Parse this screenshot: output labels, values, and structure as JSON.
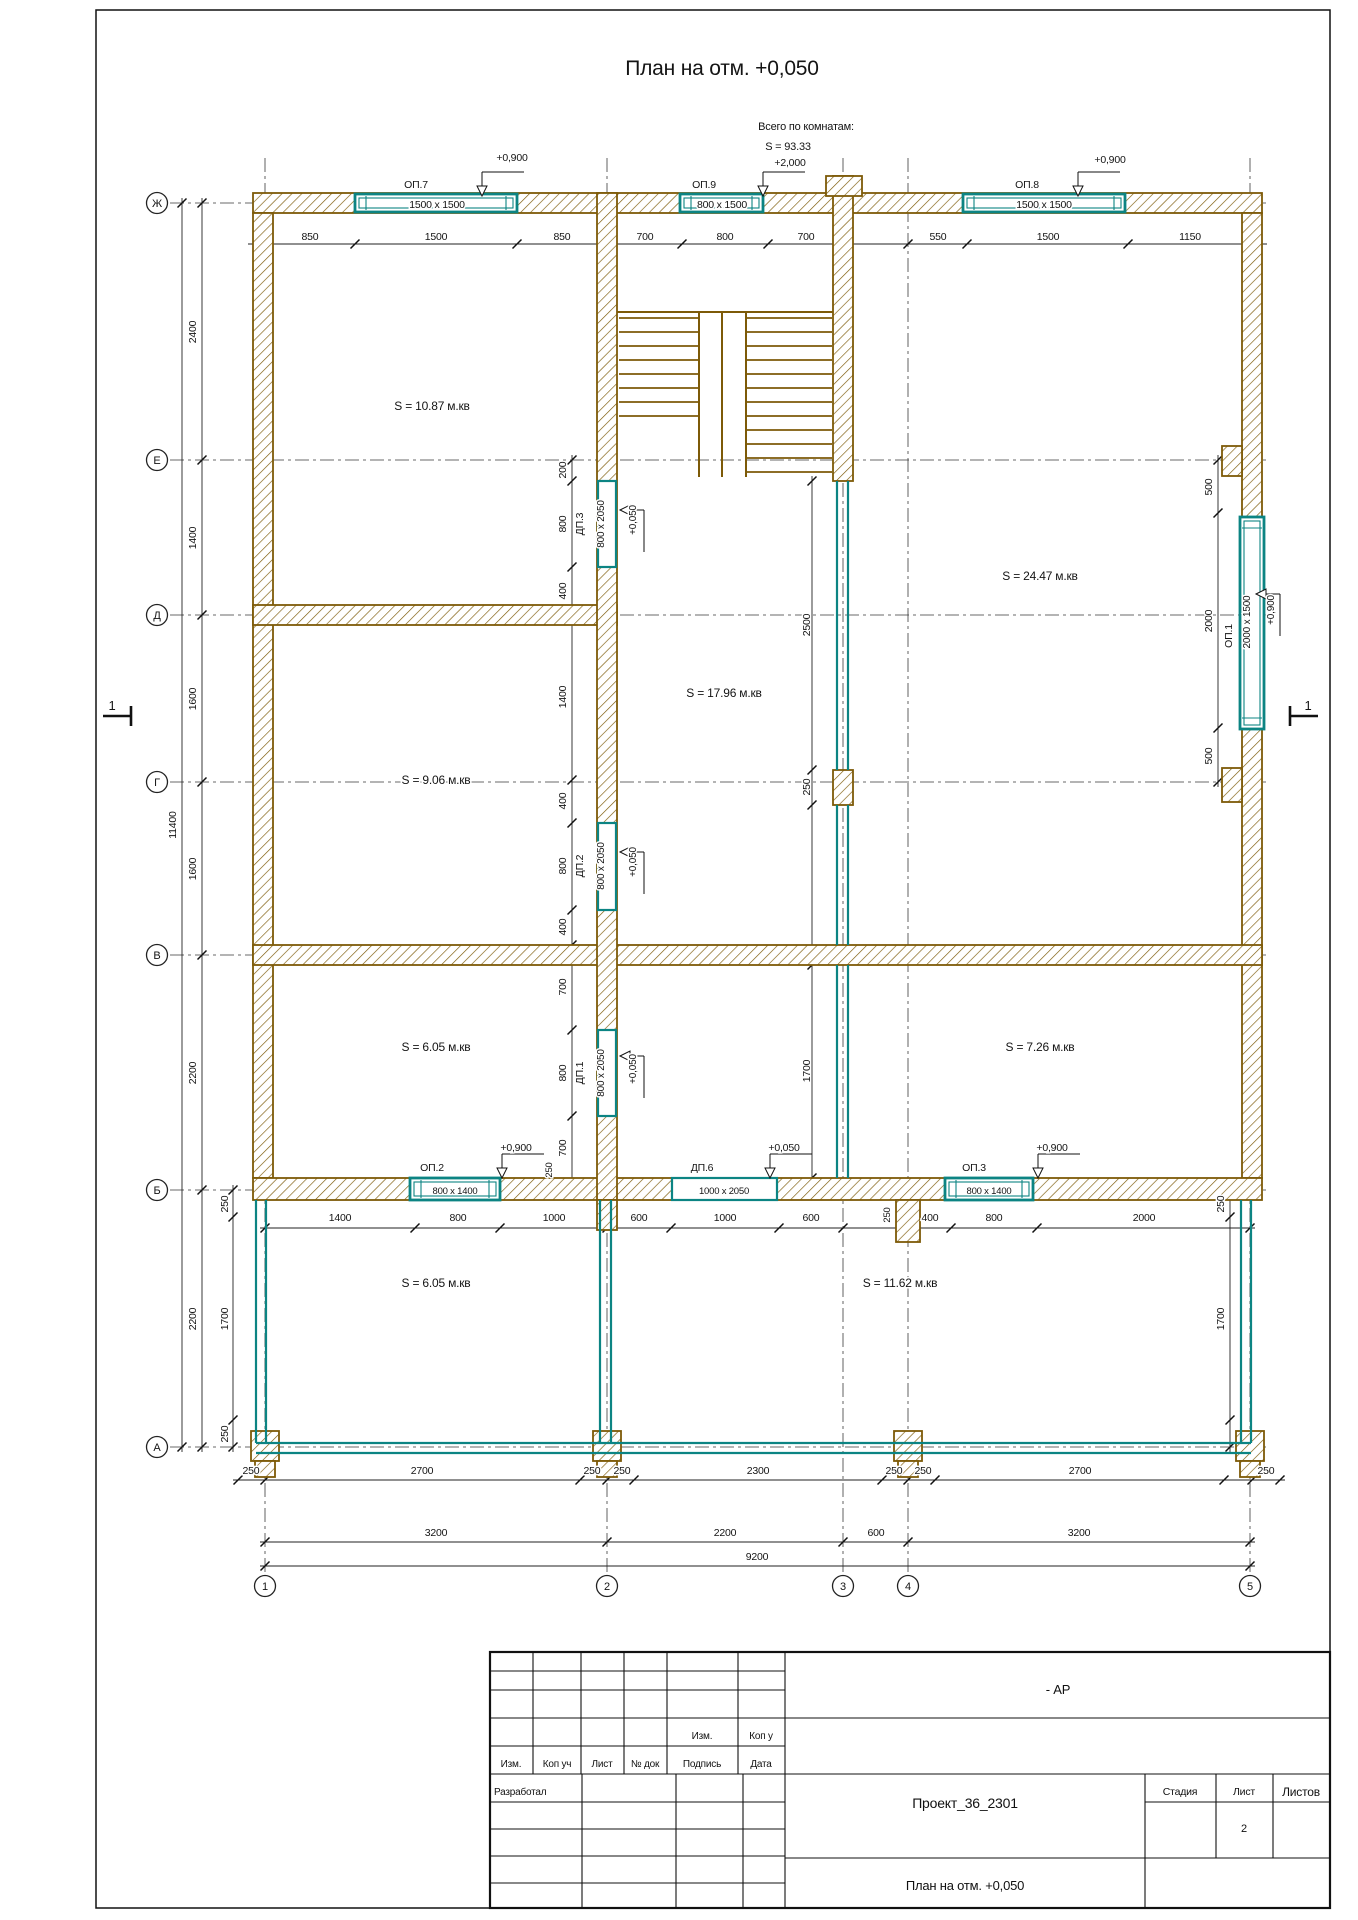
{
  "title": "План на отм. +0,050",
  "colors": {
    "wall": "#7d5a08",
    "window": "#0c8483",
    "line": "#1c1c1c",
    "axis": "#3a3a3a"
  },
  "axes": {
    "rows": [
      {
        "label": "Ж",
        "y": 203
      },
      {
        "label": "Е",
        "y": 460
      },
      {
        "label": "Д",
        "y": 615
      },
      {
        "label": "Г",
        "y": 782
      },
      {
        "label": "В",
        "y": 955
      },
      {
        "label": "Б",
        "y": 1190
      },
      {
        "label": "А",
        "y": 1447
      }
    ],
    "cols": [
      {
        "label": "1",
        "x": 265
      },
      {
        "label": "2",
        "x": 607
      },
      {
        "label": "3",
        "x": 843
      },
      {
        "label": "4",
        "x": 908
      },
      {
        "label": "5",
        "x": 1250
      }
    ]
  },
  "title_block": {
    "code_suffix": "- АР",
    "upper_izm": "Изм.",
    "upper_kop": "Коп у",
    "col_izm": "Изм.",
    "col_kop": "Коп уч",
    "col_list": "Лист",
    "col_ndok": "№ док",
    "col_podpis": "Подпись",
    "col_data": "Дата",
    "developed_by": "Разработал",
    "project_name": "Проект_36_2301",
    "stage_label": "Стадия",
    "sheet_label": "Лист",
    "sheets_label": "Листов",
    "sheet_number": "2",
    "drawing_name": "План на отм. +0,050"
  },
  "annotations": [
    {
      "n": "drawing-title",
      "t": "План на отм. +0,050",
      "x": 722,
      "y": 75,
      "s": 21
    },
    {
      "n": "note-rooms-total-1",
      "t": "Всего по комнатам:",
      "x": 806,
      "y": 130,
      "s": 11
    },
    {
      "n": "note-rooms-total-2",
      "t": "S  =  93.33",
      "x": 788,
      "y": 150,
      "s": 11
    },
    {
      "n": "level-top-middle",
      "t": "+2,000",
      "x": 790,
      "y": 166
    },
    {
      "n": "level-op7",
      "t": "+0,900",
      "x": 512,
      "y": 161
    },
    {
      "n": "level-op8",
      "t": "+0,900",
      "x": 1110,
      "y": 163
    },
    {
      "n": "op7-label",
      "t": "ОП.7",
      "x": 416,
      "y": 188
    },
    {
      "n": "op7-size",
      "t": "1500 х 1500",
      "x": 437,
      "y": 208
    },
    {
      "n": "op9-label",
      "t": "ОП.9",
      "x": 704,
      "y": 188
    },
    {
      "n": "op9-size",
      "t": "800 х 1500",
      "x": 722,
      "y": 208
    },
    {
      "n": "op8-label",
      "t": "ОП.8",
      "x": 1027,
      "y": 188
    },
    {
      "n": "op8-size",
      "t": "1500 х 1500",
      "x": 1044,
      "y": 208
    },
    {
      "n": "dim-top-1",
      "t": "850",
      "x": 310,
      "y": 240
    },
    {
      "n": "dim-top-2",
      "t": "1500",
      "x": 436,
      "y": 240
    },
    {
      "n": "dim-top-3",
      "t": "850",
      "x": 562,
      "y": 240
    },
    {
      "n": "dim-top-4",
      "t": "700",
      "x": 645,
      "y": 240
    },
    {
      "n": "dim-top-5",
      "t": "800",
      "x": 725,
      "y": 240
    },
    {
      "n": "dim-top-6",
      "t": "700",
      "x": 806,
      "y": 240
    },
    {
      "n": "dim-top-7",
      "t": "550",
      "x": 938,
      "y": 240
    },
    {
      "n": "dim-top-8",
      "t": "1500",
      "x": 1048,
      "y": 240
    },
    {
      "n": "dim-top-9",
      "t": "1150",
      "x": 1190,
      "y": 240
    },
    {
      "n": "dim-left-1",
      "t": "2400",
      "x": 196,
      "y": 332,
      "r": -90
    },
    {
      "n": "dim-left-2",
      "t": "1400",
      "x": 196,
      "y": 538,
      "r": -90
    },
    {
      "n": "dim-left-3",
      "t": "1600",
      "x": 196,
      "y": 699,
      "r": -90
    },
    {
      "n": "dim-left-4",
      "t": "1600",
      "x": 196,
      "y": 869,
      "r": -90
    },
    {
      "n": "dim-left-5",
      "t": "2200",
      "x": 196,
      "y": 1073,
      "r": -90
    },
    {
      "n": "dim-left-6",
      "t": "2200",
      "x": 196,
      "y": 1319,
      "r": -90
    },
    {
      "n": "dim-left-total",
      "t": "11400",
      "x": 176,
      "y": 825,
      "r": -90
    },
    {
      "n": "dim-left-sub-1",
      "t": "250",
      "x": 228,
      "y": 1204,
      "r": -90
    },
    {
      "n": "dim-left-sub-2",
      "t": "1700",
      "x": 228,
      "y": 1319,
      "r": -90
    },
    {
      "n": "dim-left-sub-3",
      "t": "250",
      "x": 228,
      "y": 1434,
      "r": -90
    },
    {
      "n": "dim-right-1",
      "t": "500",
      "x": 1212,
      "y": 487,
      "r": -90
    },
    {
      "n": "dim-right-2",
      "t": "2000",
      "x": 1212,
      "y": 621,
      "r": -90
    },
    {
      "n": "dim-right-3",
      "t": "500",
      "x": 1212,
      "y": 756,
      "r": -90
    },
    {
      "n": "dim-right-sub-1",
      "t": "250",
      "x": 1224,
      "y": 1204,
      "r": -90
    },
    {
      "n": "dim-right-sub-2",
      "t": "1700",
      "x": 1224,
      "y": 1319,
      "r": -90
    },
    {
      "n": "dim-ax2-1",
      "t": "200",
      "x": 566,
      "y": 470,
      "r": -90
    },
    {
      "n": "dim-ax2-2",
      "t": "800",
      "x": 566,
      "y": 524,
      "r": -90
    },
    {
      "n": "dim-ax2-3",
      "t": "400",
      "x": 566,
      "y": 591,
      "r": -90
    },
    {
      "n": "dim-ax2-4",
      "t": "1400",
      "x": 566,
      "y": 697,
      "r": -90
    },
    {
      "n": "dim-ax2-5",
      "t": "400",
      "x": 566,
      "y": 801,
      "r": -90
    },
    {
      "n": "dim-ax2-6",
      "t": "800",
      "x": 566,
      "y": 866,
      "r": -90
    },
    {
      "n": "dim-ax2-7",
      "t": "400",
      "x": 566,
      "y": 927,
      "r": -90
    },
    {
      "n": "dim-ax2-8",
      "t": "700",
      "x": 566,
      "y": 987,
      "r": -90
    },
    {
      "n": "dim-ax2-9",
      "t": "800",
      "x": 566,
      "y": 1073,
      "r": -90
    },
    {
      "n": "dim-ax2-10",
      "t": "700",
      "x": 566,
      "y": 1148,
      "r": -90
    },
    {
      "n": "dim-ax2-11",
      "t": "250",
      "x": 552,
      "y": 1170,
      "r": -90,
      "s": 9.5
    },
    {
      "n": "dim-ax3-1",
      "t": "2500",
      "x": 810,
      "y": 625,
      "r": -90
    },
    {
      "n": "dim-ax3-2",
      "t": "250",
      "x": 810,
      "y": 787,
      "r": -90
    },
    {
      "n": "dim-ax3-3",
      "t": "1700",
      "x": 810,
      "y": 1071,
      "r": -90
    },
    {
      "n": "dim-ax4-pier",
      "t": "250",
      "x": 890,
      "y": 1215,
      "r": -90,
      "s": 9.5
    },
    {
      "n": "dp3-label",
      "t": "ДП.3",
      "x": 583,
      "y": 524,
      "r": -90
    },
    {
      "n": "dp3-size",
      "t": "800 х 2050",
      "x": 604,
      "y": 524,
      "r": -90,
      "s": 10
    },
    {
      "n": "dp3-level",
      "t": "+0,050",
      "x": 636,
      "y": 520,
      "r": -90,
      "s": 10
    },
    {
      "n": "dp2-label",
      "t": "ДП.2",
      "x": 583,
      "y": 866,
      "r": -90
    },
    {
      "n": "dp2-size",
      "t": "800 х 2050",
      "x": 604,
      "y": 866,
      "r": -90,
      "s": 10
    },
    {
      "n": "dp2-level",
      "t": "+0,050",
      "x": 636,
      "y": 862,
      "r": -90,
      "s": 10
    },
    {
      "n": "dp1-label",
      "t": "ДП.1",
      "x": 583,
      "y": 1073,
      "r": -90
    },
    {
      "n": "dp1-size",
      "t": "800 х 2050",
      "x": 604,
      "y": 1073,
      "r": -90,
      "s": 10
    },
    {
      "n": "dp1-level",
      "t": "+0,050",
      "x": 636,
      "y": 1069,
      "r": -90,
      "s": 10
    },
    {
      "n": "op1-label",
      "t": "ОП.1",
      "x": 1232,
      "y": 636,
      "r": -90
    },
    {
      "n": "op1-size",
      "t": "2000 х 1500",
      "x": 1250,
      "y": 622,
      "r": -90,
      "s": 10
    },
    {
      "n": "op1-level",
      "t": "+0,900",
      "x": 1274,
      "y": 610,
      "r": -90,
      "s": 10
    },
    {
      "n": "op2-label",
      "t": "ОП.2",
      "x": 432,
      "y": 1171
    },
    {
      "n": "op2-size",
      "t": "800 х 1400",
      "x": 455,
      "y": 1194,
      "s": 9.5
    },
    {
      "n": "op2-level",
      "t": "+0,900",
      "x": 516,
      "y": 1151
    },
    {
      "n": "dp6-label",
      "t": "ДП.6",
      "x": 702,
      "y": 1171
    },
    {
      "n": "dp6-size",
      "t": "1000 х 2050",
      "x": 724,
      "y": 1194,
      "s": 9.5
    },
    {
      "n": "dp6-level",
      "t": "+0,050",
      "x": 784,
      "y": 1151
    },
    {
      "n": "op3-label",
      "t": "ОП.3",
      "x": 974,
      "y": 1171
    },
    {
      "n": "op3-size",
      "t": "800 х 1400",
      "x": 989,
      "y": 1194,
      "s": 9.5
    },
    {
      "n": "op3-level",
      "t": "+0,900",
      "x": 1052,
      "y": 1151
    },
    {
      "n": "room-area-1",
      "t": "S  =  10.87 м.кв",
      "x": 432,
      "y": 410,
      "s": 12
    },
    {
      "n": "room-area-2",
      "t": "S  =  24.47 м.кв",
      "x": 1040,
      "y": 580,
      "s": 12
    },
    {
      "n": "room-area-3",
      "t": "S  =  17.96 м.кв",
      "x": 724,
      "y": 697,
      "s": 12
    },
    {
      "n": "room-area-4",
      "t": "S  =  9.06 м.кв",
      "x": 436,
      "y": 784,
      "s": 12
    },
    {
      "n": "room-area-5",
      "t": "S  =  6.05 м.кв",
      "x": 436,
      "y": 1051,
      "s": 12
    },
    {
      "n": "room-area-6",
      "t": "S  =  7.26 м.кв",
      "x": 1040,
      "y": 1051,
      "s": 12
    },
    {
      "n": "room-area-7",
      "t": "S  =  6.05 м.кв",
      "x": 436,
      "y": 1287,
      "s": 12
    },
    {
      "n": "room-area-8",
      "t": "S  =  11.62 м.кв",
      "x": 900,
      "y": 1287,
      "s": 12
    },
    {
      "n": "dim-belowB-1",
      "t": "1400",
      "x": 340,
      "y": 1221
    },
    {
      "n": "dim-belowB-2",
      "t": "800",
      "x": 458,
      "y": 1221
    },
    {
      "n": "dim-belowB-3",
      "t": "1000",
      "x": 554,
      "y": 1221
    },
    {
      "n": "dim-belowB-4",
      "t": "600",
      "x": 639,
      "y": 1221
    },
    {
      "n": "dim-belowB-5",
      "t": "1000",
      "x": 725,
      "y": 1221
    },
    {
      "n": "dim-belowB-6",
      "t": "600",
      "x": 811,
      "y": 1221
    },
    {
      "n": "dim-belowB-7",
      "t": "400",
      "x": 930,
      "y": 1221
    },
    {
      "n": "dim-belowB-8",
      "t": "800",
      "x": 994,
      "y": 1221
    },
    {
      "n": "dim-belowB-9",
      "t": "2000",
      "x": 1144,
      "y": 1221
    },
    {
      "n": "dim-botA-1",
      "t": "250",
      "x": 251,
      "y": 1474
    },
    {
      "n": "dim-botA-2",
      "t": "2700",
      "x": 422,
      "y": 1474
    },
    {
      "n": "dim-botA-3",
      "t": "250",
      "x": 592,
      "y": 1474
    },
    {
      "n": "dim-botA-4",
      "t": "250",
      "x": 622,
      "y": 1474
    },
    {
      "n": "dim-botA-5",
      "t": "2300",
      "x": 758,
      "y": 1474
    },
    {
      "n": "dim-botA-6",
      "t": "250",
      "x": 894,
      "y": 1474
    },
    {
      "n": "dim-botA-7",
      "t": "250",
      "x": 923,
      "y": 1474
    },
    {
      "n": "dim-botA-8",
      "t": "2700",
      "x": 1080,
      "y": 1474
    },
    {
      "n": "dim-botA-9",
      "t": "250",
      "x": 1266,
      "y": 1474
    },
    {
      "n": "dim-botB-1",
      "t": "3200",
      "x": 436,
      "y": 1536
    },
    {
      "n": "dim-botB-2",
      "t": "2200",
      "x": 725,
      "y": 1536
    },
    {
      "n": "dim-botB-3",
      "t": "600",
      "x": 876,
      "y": 1536
    },
    {
      "n": "dim-botB-4",
      "t": "3200",
      "x": 1079,
      "y": 1536
    },
    {
      "n": "dim-total-9200",
      "t": "9200",
      "x": 757,
      "y": 1560
    },
    {
      "n": "section-mark-left",
      "t": "1",
      "x": 112,
      "y": 710,
      "s": 13
    },
    {
      "n": "section-mark-right",
      "t": "1",
      "x": 1308,
      "y": 710,
      "s": 13
    }
  ]
}
